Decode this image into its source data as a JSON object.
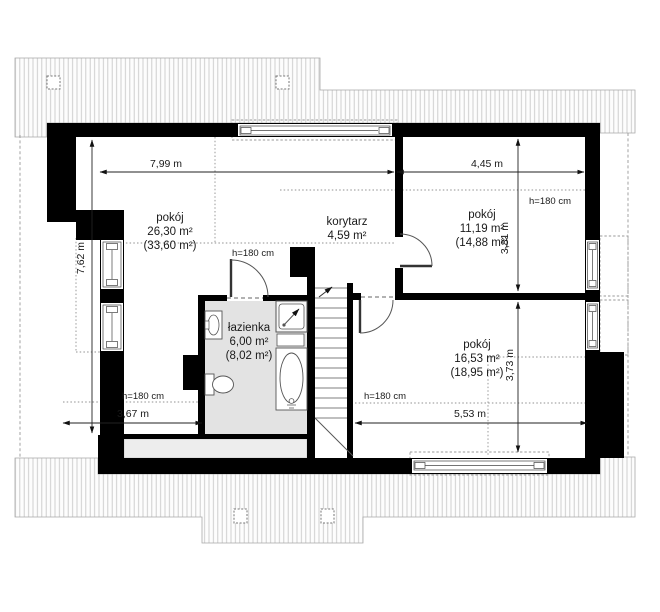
{
  "rooms": [
    {
      "id": "room-large",
      "name": "pokój",
      "area": "26,30 m²",
      "roof_area": "(33,60 m²)"
    },
    {
      "id": "corridor",
      "name": "korytarz",
      "area": "4,59 m²",
      "roof_area": ""
    },
    {
      "id": "room-upper-right",
      "name": "pokój",
      "area": "11,19 m²",
      "roof_area": "(14,88 m²)"
    },
    {
      "id": "bathroom",
      "name": "łazienka",
      "area": "6,00 m²",
      "roof_area": "(8,02 m²)"
    },
    {
      "id": "room-lower-right",
      "name": "pokój",
      "area": "16,53 m²",
      "roof_area": "(18,95 m²)"
    }
  ],
  "dimensions": {
    "width_left": "7,99 m",
    "width_right": "4,45 m",
    "depth_left": "7,62 m",
    "depth_right_upper": "3,81 m",
    "depth_right_lower": "3,73 m",
    "bottom_left": "3,67 m",
    "bottom_right": "5,53 m"
  },
  "annotations": {
    "knee_wall_height": "h=180 cm"
  },
  "colors": {
    "wall": "#000000",
    "bathroom_floor": "#e3e3e3",
    "knee_strip": "#ededed",
    "roof_line": "#c9c9c9",
    "dim": "#1a1a1a"
  }
}
